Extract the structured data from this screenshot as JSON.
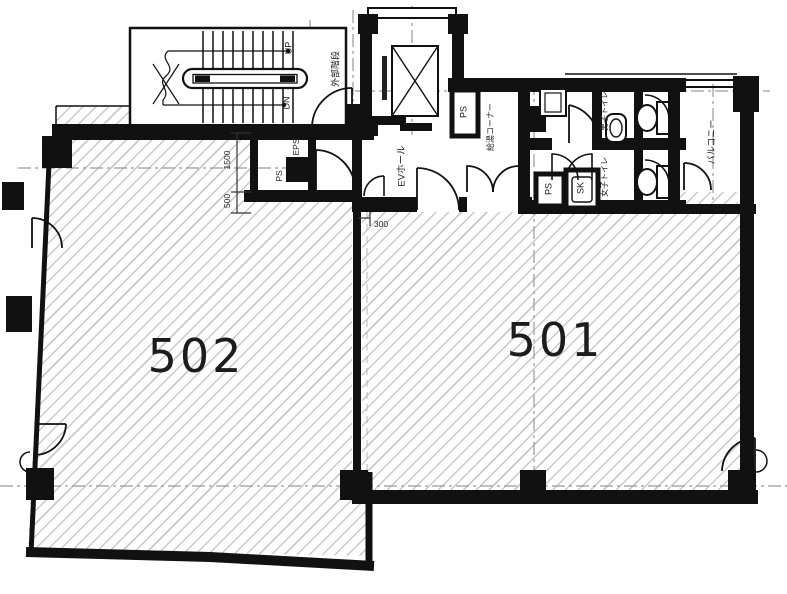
{
  "plan": {
    "unit_labels": {
      "u501": "501",
      "u502": "502"
    },
    "rooms": {
      "external_stairs": "外部階段",
      "elevator_hall": "EVホール",
      "kitchenette_corner": "給湯コーナー",
      "mens_toilet": "男子トイレ",
      "womens_toilet": "女子トイレ",
      "balcony": "バルコニー",
      "ps": "PS",
      "eps": "EPS",
      "sk": "SK"
    },
    "stairs": {
      "up": "UP",
      "dn": "DN"
    },
    "dimensions": {
      "d1500": "1500",
      "d500": "500",
      "d300": "300"
    },
    "colors": {
      "wall": "#111111",
      "hatch": "#c9c9c9",
      "chain": "#9a9a9a",
      "text": "#222222"
    }
  }
}
